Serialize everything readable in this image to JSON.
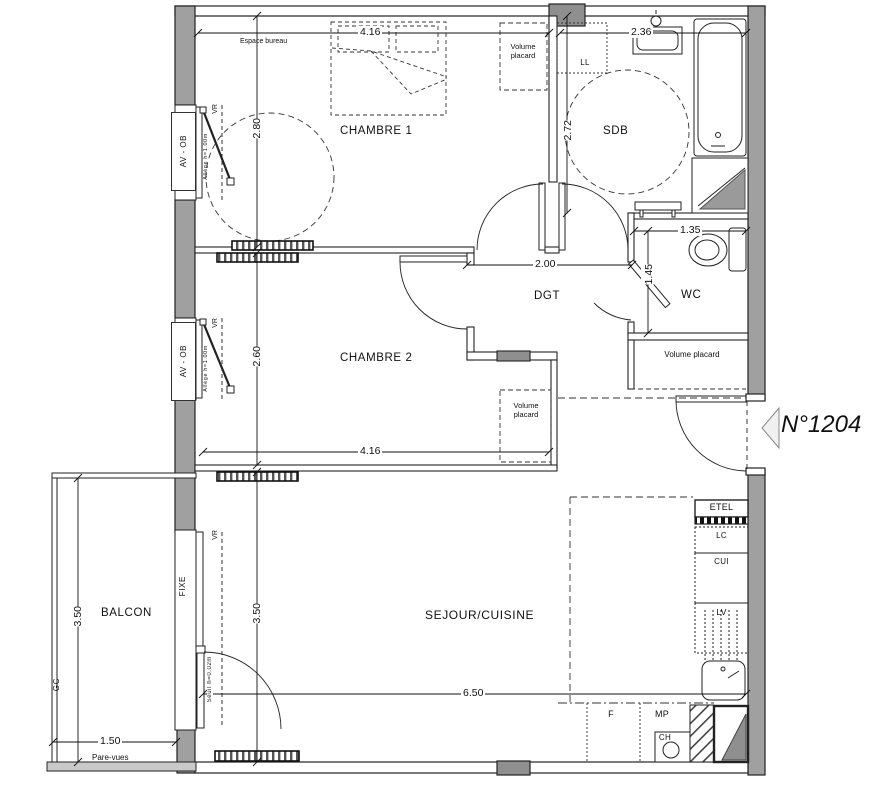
{
  "meta": {
    "unit_number": "N°1204"
  },
  "rooms": {
    "chambre1": "CHAMBRE 1",
    "chambre2": "CHAMBRE 2",
    "sdb": "SDB",
    "dgt": "DGT",
    "wc": "WC",
    "sejour_cuisine": "SEJOUR/CUISINE",
    "balcon": "BALCON"
  },
  "annotations": {
    "espace_bureau": "Espace bureau",
    "volume_placard": "Volume placard",
    "pare_vues": "Pare-vues",
    "allege": "Allège h=1.00m",
    "seuil": "Seuil h=0.02m"
  },
  "openings": {
    "av_ob": "AV - OB",
    "vr": "VR",
    "fixe": "FIXE",
    "gc": "GC"
  },
  "equipment": {
    "ll": "LL",
    "etel": "ETEL",
    "lc": "LC",
    "cui": "CUI",
    "lv": "LV",
    "f": "F",
    "mp": "MP",
    "ch": "CH"
  },
  "dimensions": {
    "chambre1_width": "4.16",
    "chambre1_depth": "2.80",
    "sdb_width": "2.36",
    "sdb_depth": "2.72",
    "dgt_width": "2.00",
    "wc_width": "1.35",
    "wc_depth": "1.45",
    "chambre2_depth": "2.60",
    "chambre2_width": "4.16",
    "balcon_depth": "3.50",
    "balcon_width": "1.50",
    "sejour_depth": "3.50",
    "sejour_width": "6.50"
  },
  "colors": {
    "wall_gray": "#a0a0a0",
    "pillar_gray": "#8f8f8f",
    "line": "#222222"
  }
}
